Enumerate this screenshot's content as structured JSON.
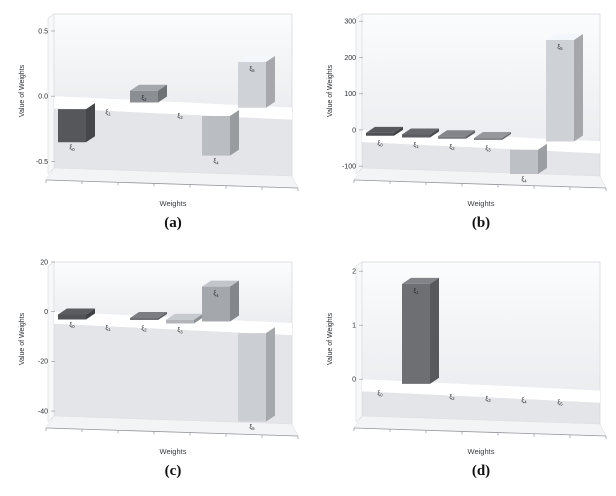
{
  "figure": {
    "name": "weights-bar3d-figure",
    "ylabel_shared": "Value of Weights",
    "xlabel_shared": "Weights"
  },
  "chart_data": [
    {
      "panel": "a",
      "caption": "(a)",
      "type": "bar",
      "projection": "3d",
      "title": "",
      "xlabel": "Weights",
      "ylabel": "Value of Weights",
      "categories": [
        "ξ0",
        "ξ1",
        "ξ2",
        "ξ3",
        "ξ4",
        "ξ5"
      ],
      "values": [
        -0.3,
        0,
        0.09,
        0,
        -0.35,
        0.35
      ],
      "bar_colors": [
        "#55575b",
        "#9b9ea2",
        "#8b8e92",
        "#9b9ea2",
        "#babec2",
        "#cfd2d6"
      ],
      "ytick_values": [
        0.5,
        0,
        -0.5
      ],
      "ytick_labels": [
        "0.5",
        "0.0",
        "-0.5"
      ],
      "ylim": [
        -0.55,
        0.63
      ],
      "grid": false,
      "legend": null
    },
    {
      "panel": "b",
      "caption": "(b)",
      "type": "bar",
      "projection": "3d",
      "title": "",
      "xlabel": "Weights",
      "ylabel": "Value of Weights",
      "categories": [
        "ξ0",
        "ξ1",
        "ξ2",
        "ξ3",
        "ξ4",
        "ξ5"
      ],
      "values": [
        -8,
        -8,
        -7,
        -4,
        -92,
        280
      ],
      "bar_colors": [
        "#4d4f53",
        "#5a5c60",
        "#75777b",
        "#86888c",
        "#bdc1c5",
        "#ced1d5"
      ],
      "ytick_values": [
        300,
        200,
        100,
        0,
        -100
      ],
      "ytick_labels": [
        "300",
        "200",
        "100",
        "0",
        "-100"
      ],
      "ylim": [
        -105,
        320
      ],
      "grid": false,
      "legend": null
    },
    {
      "panel": "c",
      "caption": "(c)",
      "type": "bar",
      "projection": "3d",
      "title": "",
      "xlabel": "Weights",
      "ylabel": "Value of Weights",
      "categories": [
        "ξ0",
        "ξ1",
        "ξ2",
        "ξ3",
        "ξ4",
        "ξ5"
      ],
      "values": [
        -2,
        0,
        -0.6,
        -1.5,
        14,
        -38
      ],
      "bar_colors": [
        "#515357",
        "#9b9ea2",
        "#6e7074",
        "#b2b5b9",
        "#a4a8ac",
        "#cbced2"
      ],
      "ytick_values": [
        20,
        0,
        -20,
        -40
      ],
      "ytick_labels": [
        "20",
        "0",
        "-20",
        "-40"
      ],
      "ylim": [
        -42,
        20
      ],
      "grid": false,
      "legend": null
    },
    {
      "panel": "d",
      "caption": "(d)",
      "type": "bar",
      "projection": "3d",
      "title": "",
      "xlabel": "Weights",
      "ylabel": "Value of Weights",
      "categories": [
        "ξ0",
        "ξ1",
        "ξ2",
        "ξ3",
        "ξ4",
        "ξ5"
      ],
      "values": [
        0,
        1.85,
        0,
        0,
        0,
        0
      ],
      "bar_colors": [
        "#9b9ea2",
        "#6d6f73",
        "#9b9ea2",
        "#9b9ea2",
        "#9b9ea2",
        "#9b9ea2"
      ],
      "ytick_values": [
        2,
        1,
        0
      ],
      "ytick_labels": [
        "2",
        "1",
        "0"
      ],
      "ylim": [
        -0.68,
        2.17
      ],
      "grid": false,
      "legend": null
    }
  ],
  "style_colors": {
    "wall_upper_top": "#fbfcfd",
    "wall_upper_bottom": "#ebedf0",
    "wall_lower": "#e4e5e8",
    "zero_band": "#ffffff",
    "left_wall": "#f7f8fa",
    "floor": "#f3f4f6",
    "edge": "#d4d5d8",
    "baseline": "#95989c",
    "text": "#2b2d31"
  }
}
